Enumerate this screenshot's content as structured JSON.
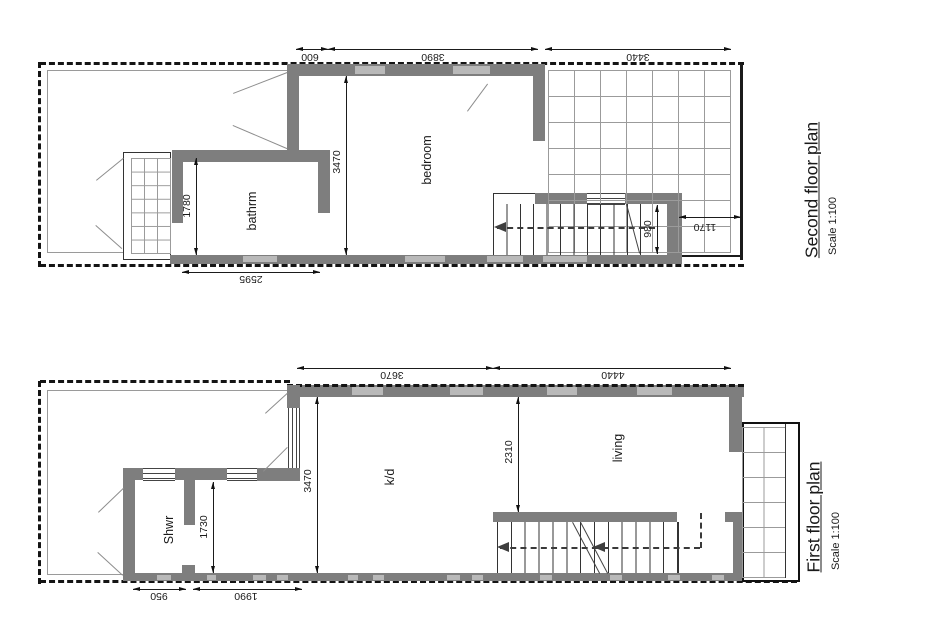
{
  "colors": {
    "wall": "#7e7e7e",
    "window": "#b9b9b9",
    "line": "#141414",
    "ink": "#1a1a1a",
    "background": "#ffffff"
  },
  "second_floor": {
    "title": "Second floor plan",
    "scale": "Scale 1:100",
    "rooms": {
      "bathroom": "bathrm",
      "bedroom": "bedroom"
    },
    "dims": {
      "top_left": "600",
      "top_mid": "3890",
      "top_right": "3440",
      "bath_height": "1780",
      "bedroom_depth": "3470",
      "bottom": "2595",
      "stair_width": "980",
      "terrace_strip": "1170"
    }
  },
  "first_floor": {
    "title": "First floor plan",
    "scale": "Scale 1:100",
    "rooms": {
      "shower": "Shwr",
      "kitchen_dining": "k/d",
      "living": "living"
    },
    "dims": {
      "top_left": "3670",
      "top_right": "4440",
      "kd_depth": "3470",
      "shower_depth": "1730",
      "living_depth": "2310",
      "bottom_left": "950",
      "bottom_right": "1990"
    }
  }
}
